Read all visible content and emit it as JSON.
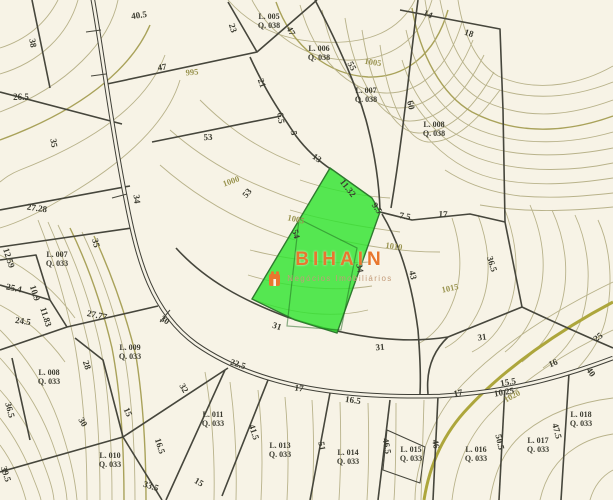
{
  "map": {
    "description": "cadastral-plat-map",
    "watermark": {
      "title": "BIHAIN",
      "subtitle": "Negócios Imobiliários"
    },
    "colors": {
      "bg": "#f7f3e6",
      "contour": "#b8b28a",
      "contour_strong": "#a9a25a",
      "contour_index": "#ada63c",
      "boundary": "#46463c",
      "road_casing": "#3f3f37",
      "road_fill": "#f5f1e4",
      "label": "#3b3b30",
      "contour_label": "#9a9450",
      "highlight_green": "#2ce42c",
      "highlight_border": "#2f7a2f",
      "watermark_title": "#e8772e",
      "watermark_subtitle": "#c39b79"
    },
    "highlighted_lot": {
      "note": "bright green lot under watermark"
    },
    "measurement_labels": [
      {
        "t": "40.5",
        "x": 139,
        "y": 15,
        "r": -8
      },
      {
        "t": "38",
        "x": 33,
        "y": 43,
        "r": 80
      },
      {
        "t": "23",
        "x": 233,
        "y": 28,
        "r": 72
      },
      {
        "t": "47",
        "x": 291,
        "y": 31,
        "r": 62
      },
      {
        "t": "14",
        "x": 428,
        "y": 14,
        "r": 25
      },
      {
        "t": "18",
        "x": 469,
        "y": 33,
        "r": 18
      },
      {
        "t": "26.5",
        "x": 21,
        "y": 97,
        "r": 0
      },
      {
        "t": "47",
        "x": 162,
        "y": 67,
        "r": -8
      },
      {
        "t": "21",
        "x": 262,
        "y": 83,
        "r": 70
      },
      {
        "t": "55",
        "x": 352,
        "y": 66,
        "r": 62
      },
      {
        "t": "60",
        "x": 411,
        "y": 105,
        "r": 78
      },
      {
        "t": "53",
        "x": 208,
        "y": 137,
        "r": -3
      },
      {
        "t": "6.5",
        "x": 281,
        "y": 118,
        "r": 82
      },
      {
        "t": "5",
        "x": 294,
        "y": 133,
        "r": 80
      },
      {
        "t": "13",
        "x": 317,
        "y": 158,
        "r": 35
      },
      {
        "t": "35",
        "x": 54,
        "y": 143,
        "r": 82
      },
      {
        "t": "34",
        "x": 137,
        "y": 199,
        "r": 83
      },
      {
        "t": "27.28",
        "x": 37,
        "y": 208,
        "r": 8
      },
      {
        "t": "53",
        "x": 247,
        "y": 193,
        "r": -50
      },
      {
        "t": "11.32",
        "x": 348,
        "y": 188,
        "r": 52
      },
      {
        "t": "9.5",
        "x": 377,
        "y": 208,
        "r": 55
      },
      {
        "t": "7.5",
        "x": 405,
        "y": 216,
        "r": 10
      },
      {
        "t": "17",
        "x": 443,
        "y": 214,
        "r": 3
      },
      {
        "t": "54",
        "x": 296,
        "y": 234,
        "r": 75
      },
      {
        "t": "34",
        "x": 360,
        "y": 268,
        "r": 80
      },
      {
        "t": "43",
        "x": 413,
        "y": 275,
        "r": 78
      },
      {
        "t": "36.5",
        "x": 492,
        "y": 264,
        "r": 72
      },
      {
        "t": "35",
        "x": 96,
        "y": 243,
        "r": 75
      },
      {
        "t": "27.77",
        "x": 97,
        "y": 315,
        "r": 12
      },
      {
        "t": "12.59",
        "x": 9,
        "y": 258,
        "r": 72
      },
      {
        "t": "25.4",
        "x": 14,
        "y": 288,
        "r": 12
      },
      {
        "t": "10.9",
        "x": 35,
        "y": 293,
        "r": 72
      },
      {
        "t": "11.83",
        "x": 46,
        "y": 317,
        "r": 72
      },
      {
        "t": "24.5",
        "x": 23,
        "y": 321,
        "r": 8
      },
      {
        "t": "30",
        "x": 165,
        "y": 320,
        "r": 32
      },
      {
        "t": "28",
        "x": 87,
        "y": 365,
        "r": 72
      },
      {
        "t": "31",
        "x": 277,
        "y": 326,
        "r": 18
      },
      {
        "t": "22.5",
        "x": 238,
        "y": 364,
        "r": 18
      },
      {
        "t": "31",
        "x": 380,
        "y": 347,
        "r": -5
      },
      {
        "t": "31",
        "x": 482,
        "y": 337,
        "r": -8
      },
      {
        "t": "25",
        "x": 598,
        "y": 337,
        "r": -38
      },
      {
        "t": "16",
        "x": 553,
        "y": 363,
        "r": -22
      },
      {
        "t": "40",
        "x": 591,
        "y": 372,
        "r": 55
      },
      {
        "t": "36.5",
        "x": 10,
        "y": 410,
        "r": 75
      },
      {
        "t": "30",
        "x": 83,
        "y": 422,
        "r": 60
      },
      {
        "t": "15",
        "x": 128,
        "y": 412,
        "r": 65
      },
      {
        "t": "32",
        "x": 184,
        "y": 388,
        "r": 60
      },
      {
        "t": "16.5",
        "x": 160,
        "y": 446,
        "r": 72
      },
      {
        "t": "15",
        "x": 199,
        "y": 482,
        "r": 30
      },
      {
        "t": "33.5",
        "x": 151,
        "y": 486,
        "r": 18
      },
      {
        "t": "39.5",
        "x": 6,
        "y": 474,
        "r": 72
      },
      {
        "t": "17",
        "x": 299,
        "y": 388,
        "r": 8
      },
      {
        "t": "16.5",
        "x": 353,
        "y": 400,
        "r": 8
      },
      {
        "t": "41.5",
        "x": 254,
        "y": 432,
        "r": 72
      },
      {
        "t": "51",
        "x": 322,
        "y": 446,
        "r": 80
      },
      {
        "t": "46.5",
        "x": 387,
        "y": 446,
        "r": 80
      },
      {
        "t": "46",
        "x": 436,
        "y": 444,
        "r": 80
      },
      {
        "t": "50.5",
        "x": 500,
        "y": 442,
        "r": 78
      },
      {
        "t": "47.5",
        "x": 557,
        "y": 431,
        "r": 75
      },
      {
        "t": "17",
        "x": 458,
        "y": 393,
        "r": -12
      },
      {
        "t": "15.5",
        "x": 508,
        "y": 382,
        "r": -10
      },
      {
        "t": "10.25",
        "x": 504,
        "y": 392,
        "r": -10
      }
    ],
    "lot_labels": [
      {
        "l": "L. 005",
        "q": "Q. 038",
        "x": 269,
        "y": 21
      },
      {
        "l": "L. 006",
        "q": "Q. 038",
        "x": 319,
        "y": 53
      },
      {
        "l": "L. 007",
        "q": "Q. 038",
        "x": 366,
        "y": 95
      },
      {
        "l": "L. 008",
        "q": "Q. 038",
        "x": 434,
        "y": 129
      },
      {
        "l": "L. 007",
        "q": "Q. 033",
        "x": 57,
        "y": 259
      },
      {
        "l": "L. 009",
        "q": "Q. 033",
        "x": 130,
        "y": 352
      },
      {
        "l": "L. 008",
        "q": "Q. 033",
        "x": 49,
        "y": 377
      },
      {
        "l": "L. 010",
        "q": "Q. 033",
        "x": 110,
        "y": 460
      },
      {
        "l": "L. 011",
        "q": "Q. 033",
        "x": 213,
        "y": 419
      },
      {
        "l": "L. 013",
        "q": "Q. 033",
        "x": 280,
        "y": 450
      },
      {
        "l": "L. 014",
        "q": "Q. 033",
        "x": 348,
        "y": 457
      },
      {
        "l": "L. 015",
        "q": "Q. 033",
        "x": 411,
        "y": 454
      },
      {
        "l": "L. 016",
        "q": "Q. 033",
        "x": 476,
        "y": 454
      },
      {
        "l": "L. 017",
        "q": "Q. 033",
        "x": 538,
        "y": 445
      },
      {
        "l": "L. 018",
        "q": "Q. 033",
        "x": 581,
        "y": 419
      }
    ],
    "contour_labels": [
      {
        "t": "995",
        "x": 192,
        "y": 72,
        "r": -5
      },
      {
        "t": "1005",
        "x": 373,
        "y": 62,
        "r": 8
      },
      {
        "t": "1000",
        "x": 231,
        "y": 181,
        "r": -20
      },
      {
        "t": "1005",
        "x": 296,
        "y": 219,
        "r": 12
      },
      {
        "t": "1010",
        "x": 394,
        "y": 246,
        "r": 8
      },
      {
        "t": "1015",
        "x": 450,
        "y": 288,
        "r": -12
      },
      {
        "t": "1020",
        "x": 512,
        "y": 396,
        "r": -28
      }
    ]
  }
}
